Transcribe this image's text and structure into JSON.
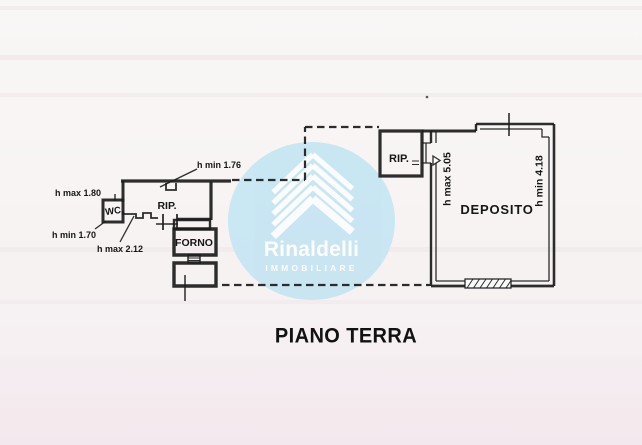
{
  "title": "PIANO TERRA",
  "watermark": {
    "brand": "Rinaldelli",
    "subtitle": "IMMOBILIARE"
  },
  "rooms": {
    "wc": "WC",
    "rip_left": "RIP.",
    "forno": "FORNO",
    "rip_right": "RIP.",
    "deposito": "DEPOSITO"
  },
  "dimensions": {
    "h_max_180": "h max 1.80",
    "h_min_170": "h min 1.70",
    "h_max_212": "h max 2.12",
    "h_min_176": "h min 1.76",
    "h_max_505": "h max 5.05",
    "h_min_418": "h min 4.18"
  },
  "colors": {
    "line": "#1d1d1d",
    "watermark_circle": "#c6e5f3",
    "watermark_text": "#ffffff",
    "paper": "#f7f4f3"
  }
}
